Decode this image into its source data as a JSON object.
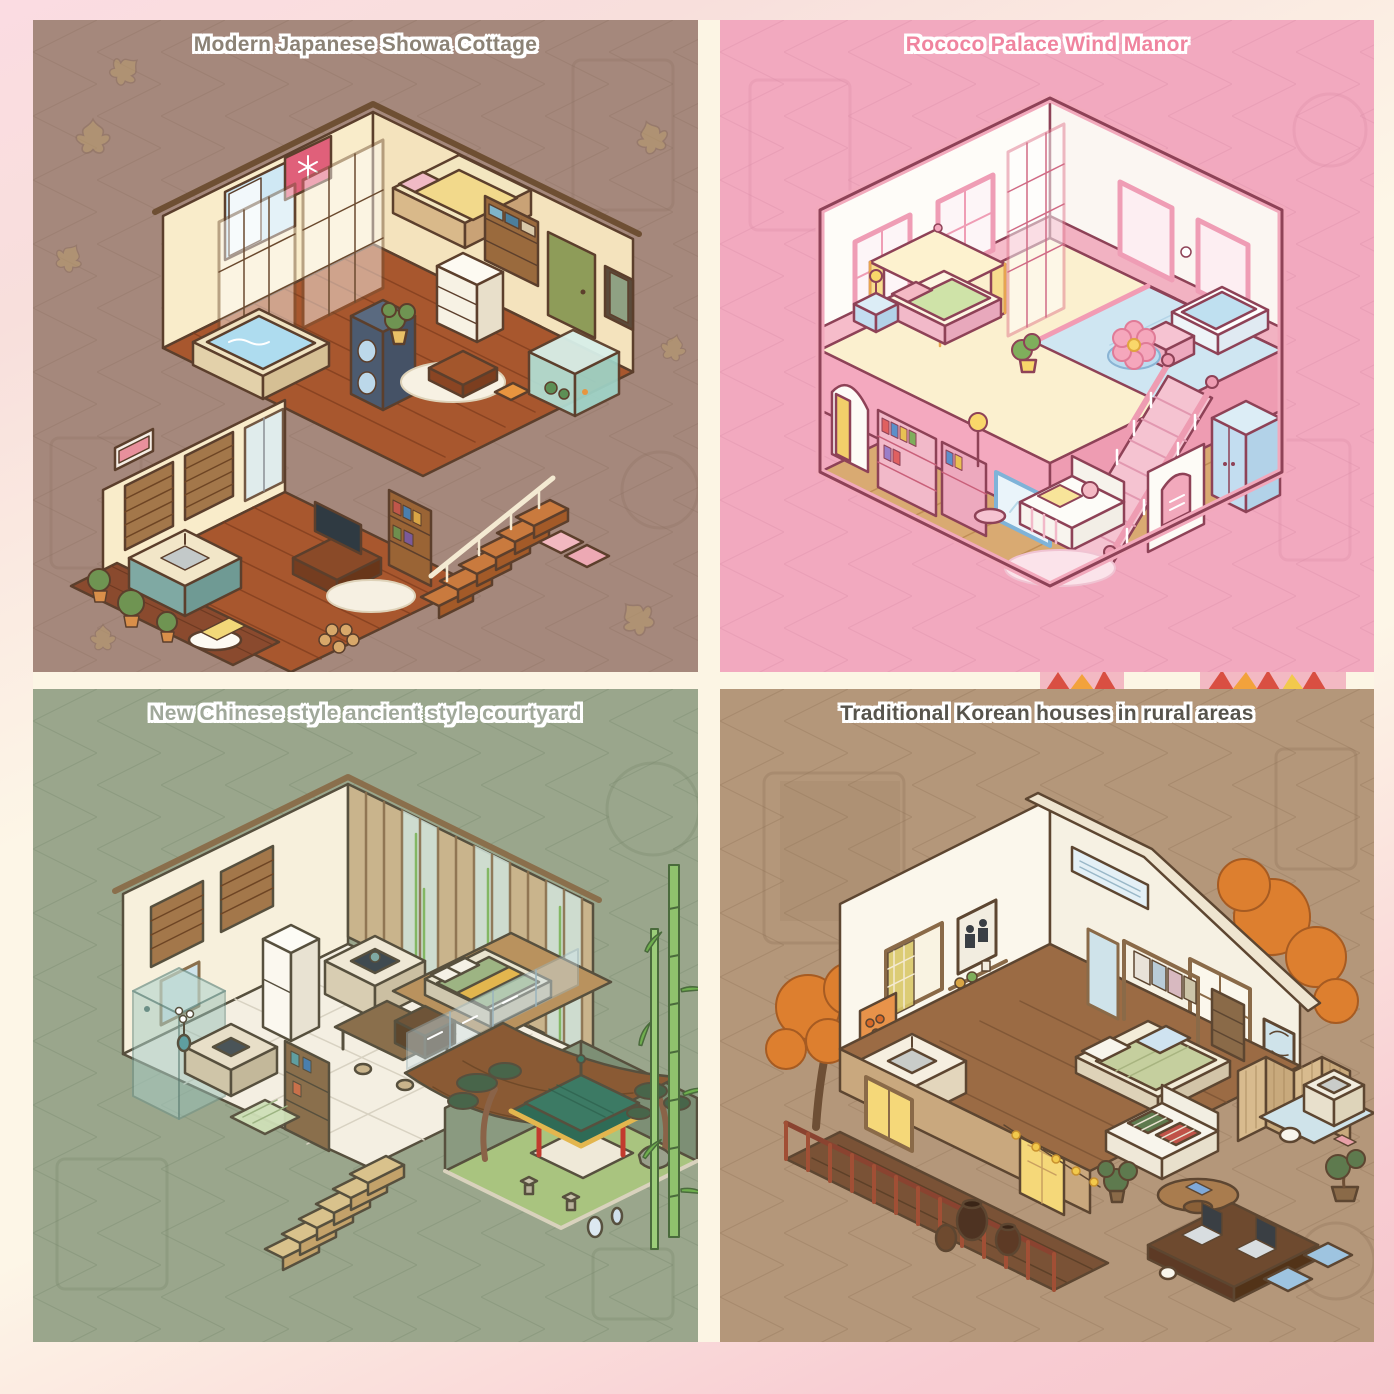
{
  "page": {
    "type": "four-panel isometric room illustration collage",
    "frame": {
      "top_pink": "#fadce2",
      "cream": "#fdf6e7",
      "bottom_pink": "#f7c6cd",
      "gutter": "#fcf5e4"
    },
    "gutter_decor": {
      "background": "#f3b9c3",
      "ray_red": "#d94f42",
      "ray_orange": "#f2a23c",
      "ray_yellow": "#f2c94c"
    }
  },
  "panels": [
    {
      "id": "modern-japanese-showa-cottage",
      "title": "Modern Japanese Showa Cottage",
      "colors": {
        "background": "#a5887c",
        "pattern": "#8d7060",
        "title": "#8b8275"
      }
    },
    {
      "id": "rococo-palace-wind-manor",
      "title": "Rococo Palace Wind Manor",
      "colors": {
        "background": "#f2a9bf",
        "pattern": "#d98ba6",
        "title": "#f0849f"
      }
    },
    {
      "id": "new-chinese-ancient-style-courtyard",
      "title": "New Chinese style ancient style courtyard",
      "colors": {
        "background": "#9aa68c",
        "pattern": "#76856a",
        "title": "#a0a89a"
      }
    },
    {
      "id": "traditional-korean-rural-houses",
      "title": "Traditional Korean houses in rural areas",
      "colors": {
        "background": "#b4977a",
        "pattern": "#8f7257",
        "title": "#57544c"
      }
    }
  ]
}
